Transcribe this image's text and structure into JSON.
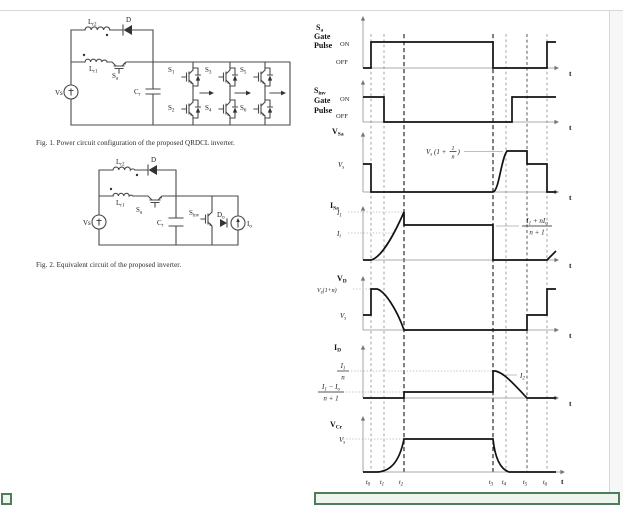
{
  "figures": {
    "fig1": {
      "caption": "Fig. 1.   Power circuit configuration of the proposed QRDCL inverter.",
      "labels": {
        "vs": "Vs",
        "d": "D",
        "lr2": {
          "b": "L",
          "s": "r2"
        },
        "lr1": {
          "b": "L",
          "s": "r1"
        },
        "sa": {
          "b": "S",
          "s": "a"
        },
        "cr": {
          "b": "C",
          "s": "r"
        },
        "s1": {
          "b": "S",
          "s": "1"
        },
        "s2": {
          "b": "S",
          "s": "2"
        },
        "s3": {
          "b": "S",
          "s": "3"
        },
        "s4": {
          "b": "S",
          "s": "4"
        },
        "s5": {
          "b": "S",
          "s": "5"
        },
        "s6": {
          "b": "S",
          "s": "6"
        }
      }
    },
    "fig2": {
      "caption": "Fig. 2.   Equivalent circuit of the proposed inverter.",
      "labels": {
        "vs": "Vs",
        "d": "D",
        "lr2": {
          "b": "L",
          "s": "r2"
        },
        "lr1": {
          "b": "L",
          "s": "r1"
        },
        "sa": {
          "b": "S",
          "s": "a"
        },
        "cr": {
          "b": "C",
          "s": "r"
        },
        "sinv": {
          "b": "S",
          "s": "inv"
        },
        "do": {
          "b": "D",
          "s": "o"
        },
        "io": {
          "b": "I",
          "s": "o"
        }
      }
    }
  },
  "timing": {
    "t_axis": "t",
    "time_labels": [
      {
        "b": "t",
        "s": "0"
      },
      {
        "b": "t",
        "s": "1"
      },
      {
        "b": "t",
        "s": "2"
      },
      {
        "b": "t",
        "s": "3"
      },
      {
        "b": "t",
        "s": "4"
      },
      {
        "b": "t",
        "s": "5"
      },
      {
        "b": "t",
        "s": "6"
      }
    ],
    "panels": {
      "sa_gate": {
        "name1": {
          "b": "S",
          "s": "a"
        },
        "name2": "Gate",
        "name3": "Pulse",
        "on": "ON",
        "off": "OFF"
      },
      "sinv_gate": {
        "name1": {
          "b": "S",
          "s": "inv"
        },
        "name2": "Gate",
        "name3": "Pulse",
        "on": "ON",
        "off": "OFF"
      },
      "vsa": {
        "name": {
          "b": "V",
          "s": "Sa"
        },
        "vs": {
          "b": "V",
          "s": "s"
        },
        "ann": {
          "p1": "V",
          "s1": "s",
          "p2": " (1 + ",
          "num": "1",
          "den": "n",
          "p3": ")"
        }
      },
      "isa": {
        "name": {
          "b": "I",
          "s": "Sa"
        },
        "i1": {
          "b": "I",
          "s": "1"
        },
        "ii": {
          "b": "I",
          "s": "i"
        },
        "frac": {
          "n1": "I",
          "ns1": "1",
          "n2": " + n",
          "n3": "I",
          "ns2": "o",
          "den": "n + 1"
        }
      },
      "vd": {
        "name": {
          "b": "V",
          "s": "D"
        },
        "hi": {
          "p1": "V",
          "s1": "s",
          "p2": "(1+n)"
        },
        "vs": {
          "b": "V",
          "s": "s"
        }
      },
      "id": {
        "name": {
          "b": "I",
          "s": "D"
        },
        "frac_hi": {
          "n1": "I",
          "ns1": "1",
          "den": "n"
        },
        "frac_lo": {
          "n1": "I",
          "ns1": "1",
          "n2": " − ",
          "n3": "I",
          "ns2": "o",
          "den": "n + 1"
        },
        "i2": {
          "b": "I",
          "s": "2"
        }
      },
      "vcr": {
        "name": {
          "b": "V",
          "s": "Cr"
        },
        "vs": {
          "b": "V",
          "s": "s"
        }
      }
    },
    "behavior": {
      "sa_gate": "OFF before t0; ON t0-t3; OFF t3-t6; ON after t6",
      "sinv_gate": "ON before t1; OFF t1 to just before t5; ON after",
      "vsa": "Vs before t0; 0 from t0-t3; rises to Vs(1+1/n) by t4; steps down to Vs at t5; 0 after t6",
      "isa": "0 before t0; rises to I1 at t2; (I1+nIo)/(n+1) from t2-t3; 0 t3-t6; ramps up after t6",
      "vd": "Vs before t0; Vs(1+n) at t0 decaying to 0 by t2; 0 until t5; Vs t5-t6; Vs(1+n) after t6",
      "id": "0 before t2; (I1-Io)/(n+1) t2-t3; jumps to I1/n at t3 decaying through I2 to 0 at t5",
      "vcr": "0 before t1; rises to Vs by t2; holds Vs t2-t3; decays to 0 by t4"
    }
  }
}
